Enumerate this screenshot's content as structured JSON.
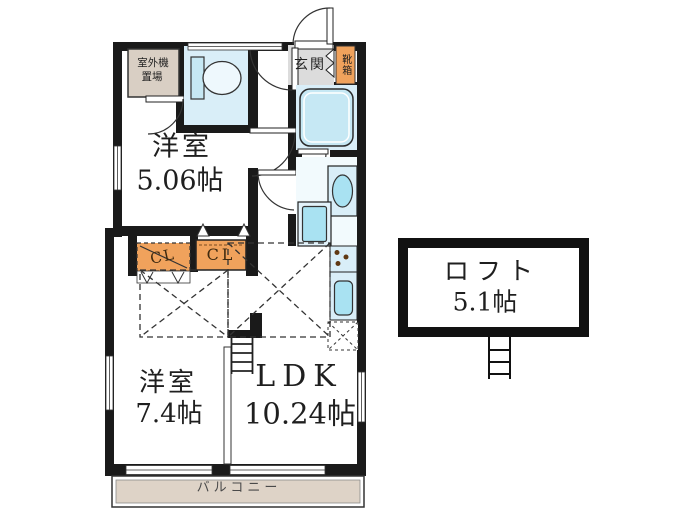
{
  "floorplan": {
    "rooms": {
      "outdoor_unit": {
        "line1": "室外機",
        "line2": "置場"
      },
      "entrance": {
        "label": "玄関"
      },
      "shoe_box": {
        "label": "靴箱"
      },
      "western_room_1": {
        "name": "洋室",
        "size": "5.06帖"
      },
      "western_room_2": {
        "name": "洋室",
        "size": "7.4帖"
      },
      "ldk": {
        "name": "LDK",
        "size": "10.24帖"
      },
      "loft": {
        "name": "ロフト",
        "size": "5.1帖"
      },
      "balcony": {
        "label": "バルコニー"
      }
    },
    "closets": {
      "cl1": {
        "label": "CL"
      },
      "cl2": {
        "label": "CL"
      }
    }
  },
  "colors": {
    "wall": "#1a1a1a",
    "water": "#d9eef8",
    "fixture": "#a9e2f2",
    "tub": "#c6e8f4",
    "orange": "#f0a25c",
    "beige": "#d9cfc4",
    "gray": "#dcdcdc",
    "balcony": "#ded3c7"
  }
}
